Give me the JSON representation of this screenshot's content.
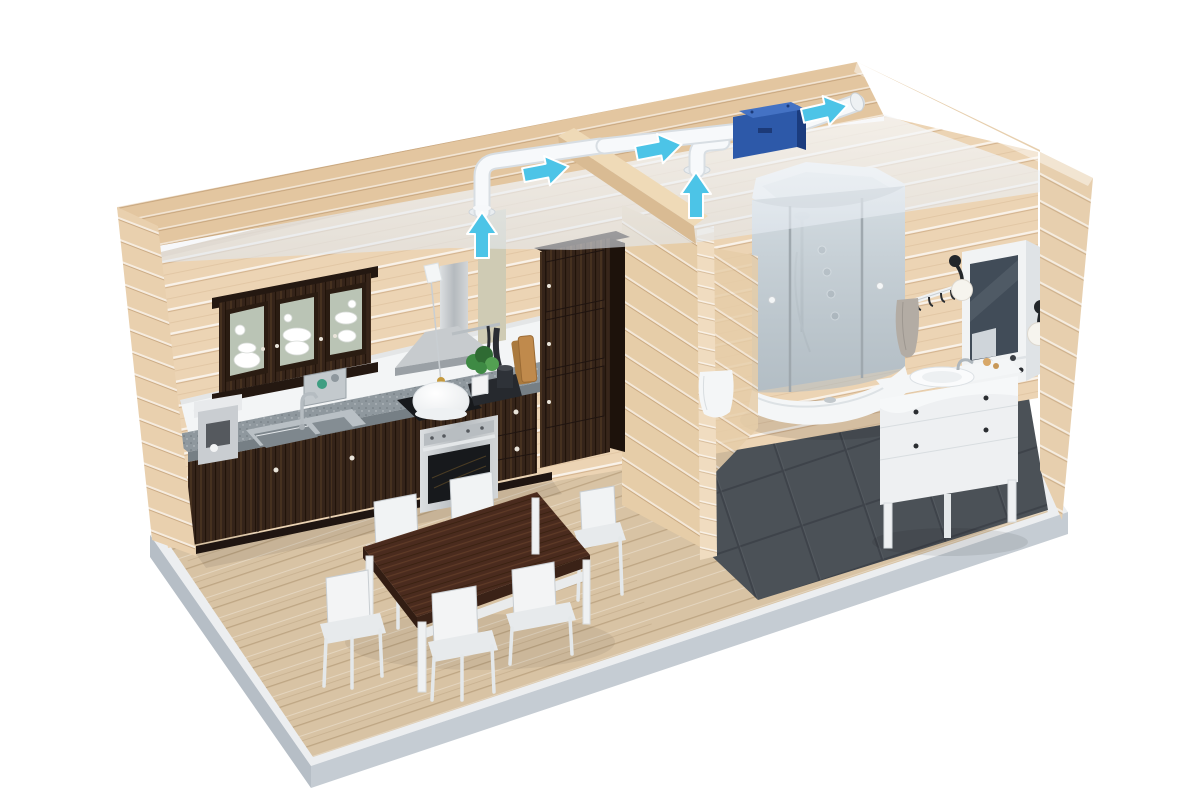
{
  "scene": {
    "type": "3d-cutaway-render",
    "subject": "house-ventilation-system",
    "left_room": "kitchen-dining",
    "right_room": "bathroom",
    "dining_chair_count": 6,
    "ceiling_extract_points": 2,
    "duct_airflow_arrows_up": 2,
    "duct_airflow_arrows_along": 3,
    "fan_unit_count": 1
  },
  "colors": {
    "bg": "#ffffff",
    "slab_top": "#eceef0",
    "plinth_left": "#b6bec6",
    "plinth_right": "#c5ccd3",
    "floor_wood": "#d8c3a4",
    "floor_tile": "#4b5157",
    "wall_wood": "#ecd4b4",
    "wall_band": "#e3c6a0",
    "wall_strip": "#e9d0ae",
    "wall_strip_e": "#e7cfae",
    "partition_wood": "#e6cda8",
    "partition_cut": "#f0dcc0",
    "beam_top": "#efdab7",
    "beam_side": "#d9bb93",
    "backsplash": "#f3f5f6",
    "ceiling_hi": "#f8fafc",
    "cabinet_dark": "#342319",
    "cabinet_dark2": "#2a1c12",
    "counter": "#8f989e",
    "counter_edge": "#767f85",
    "steel": "#c7cbce",
    "steel_dark": "#9aa0a5",
    "white_furniture": "#f1f3f4",
    "white_shade": "#dce0e3",
    "white_stroke": "#c9ced2",
    "table_top": "#4a2b1e",
    "glass_green": "#c7d3c3",
    "shower_glass": "#cdd7de",
    "mirror": "#414c58",
    "sconce_black": "#22262a",
    "globe": "#f6f4ee",
    "towel": "#b3aca4",
    "plant": "#3e8a44",
    "board": "#c08a4c",
    "tray_black": "#26292e",
    "duct": "#f7f9fb",
    "duct_edge": "#d6dce1",
    "fan_body": "#2d59a9",
    "fan_top": "#4472c4",
    "fan_dark": "#1b3c7e",
    "arrow": "#4cc4e7"
  }
}
